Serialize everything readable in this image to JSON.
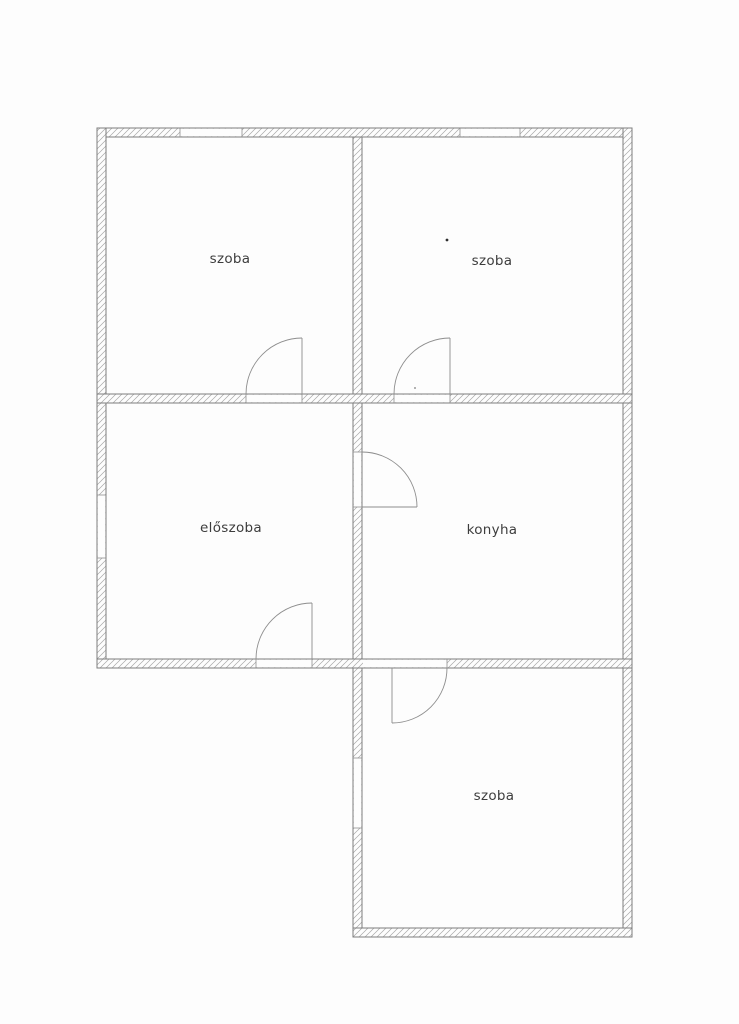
{
  "page": {
    "background": "#fdfdfd",
    "kind": "scanned apartment floor plan"
  },
  "plan": {
    "colors": {
      "wall_line": "#7d7d7d",
      "hatch": "#a6a6a6",
      "door_line": "#8d8d8d",
      "window_line": "#8f8f8f",
      "label": "#3d3d3d"
    },
    "rooms": [
      {
        "id": "szoba-top-left",
        "label": "szoba"
      },
      {
        "id": "szoba-top-right",
        "label": "szoba"
      },
      {
        "id": "eloszoba",
        "label": "előszoba"
      },
      {
        "id": "konyha",
        "label": "konyha"
      },
      {
        "id": "szoba-bottom",
        "label": "szoba"
      }
    ],
    "doors": [
      {
        "id": "door-szoba-top-left",
        "located": "bottom wall of top-left szoba, swings up-left"
      },
      {
        "id": "door-szoba-top-right",
        "located": "bottom wall of top-right szoba, swings up-left"
      },
      {
        "id": "door-eloszoba",
        "located": "bottom wall of előszoba, swings up-left"
      },
      {
        "id": "door-konyha",
        "located": "left wall of konyha, swings right-up"
      },
      {
        "id": "door-szoba-bottom",
        "located": "top wall of bottom szoba, swings down-right"
      }
    ],
    "windows": [
      {
        "id": "window-top-wall-left",
        "located": "top exterior wall, left room"
      },
      {
        "id": "window-top-wall-right",
        "located": "top exterior wall, right room"
      },
      {
        "id": "window-left-wall",
        "located": "left exterior wall, előszoba"
      },
      {
        "id": "window-bottom-room-left",
        "located": "left exterior wall, bottom szoba"
      }
    ]
  }
}
